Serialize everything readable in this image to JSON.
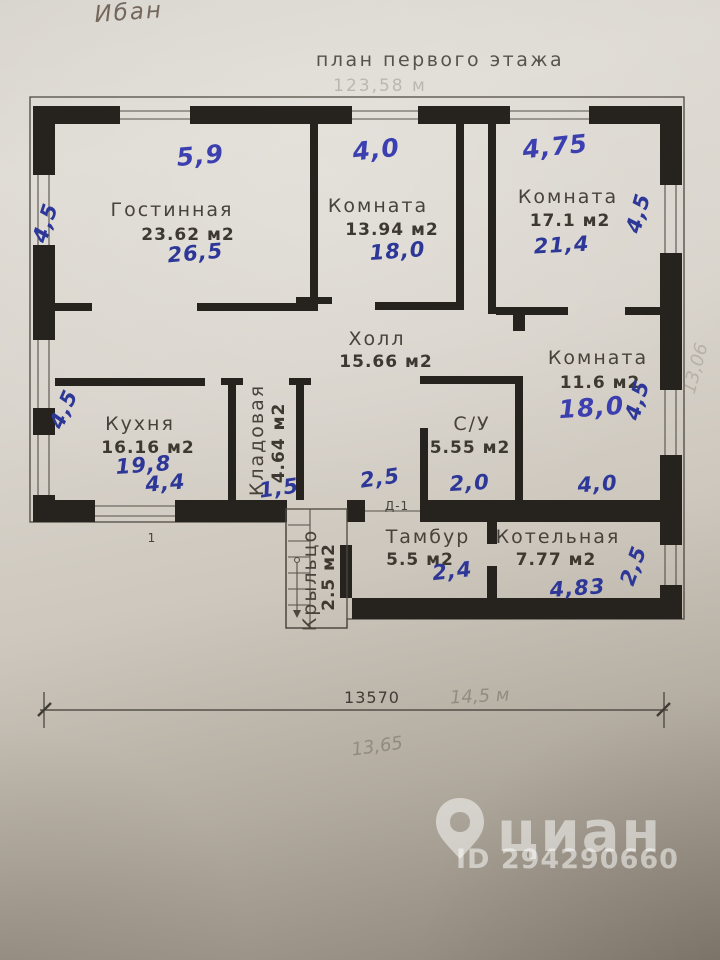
{
  "header": {
    "scribble": "Ибан",
    "title": "план первого этажа",
    "total_area_faint": "123,58 м"
  },
  "rooms": {
    "living": {
      "name": "Гостинная",
      "area": "23.62 м2",
      "hand": "26,5",
      "dim_top": "5,9",
      "dim_left": "4,5"
    },
    "bedroom_mid": {
      "name": "Комната",
      "area": "13.94 м2",
      "hand": "18,0",
      "dim_top": "4,0"
    },
    "bedroom_right": {
      "name": "Комната",
      "area": "17.1 м2",
      "hand": "21,4",
      "dim_top": "4,75",
      "dim_right": "4,5"
    },
    "hall": {
      "name": "Холл",
      "area": "15.66 м2"
    },
    "bedroom_small": {
      "name": "Комната",
      "area": "11.6 м2",
      "hand": "18,0",
      "dim_right": "4,5",
      "dim_bottom": "4,0"
    },
    "kitchen": {
      "name": "Кухня",
      "area": "16.16 м2",
      "hand": "19,8",
      "dim_left": "4,5",
      "dim_bottom": "4,4"
    },
    "pantry": {
      "name": "Кладовая",
      "area": "4.64 м2",
      "dim_bottom": "1,5"
    },
    "bathroom": {
      "name": "С/У",
      "area": "5.55 м2",
      "hand": "2,0",
      "dim_left": "2,5"
    },
    "tambour": {
      "name": "Тамбур",
      "area": "5.5 м2",
      "dim_bottom": "2,4"
    },
    "boiler": {
      "name": "Котельная",
      "area": "7.77 м2",
      "dim_bottom": "4,83",
      "dim_right": "2,5"
    },
    "porch": {
      "name": "Крыльцо",
      "area": "2.5 м2"
    }
  },
  "plan_labels": {
    "door": "Д-1",
    "wall_mark": "1"
  },
  "dimension": {
    "value": "13570",
    "pencil_note": "14,5 м",
    "pencil_note2": "13,65",
    "pencil_margin": "13,06"
  },
  "watermark": {
    "brand": "циан",
    "listing_id": "ID 294290660"
  },
  "colors": {
    "ink_blue": "#2c3798",
    "plan_black": "#26231e",
    "print_grey": "#47433a",
    "paper_light": "#dedad3",
    "paper_dark": "#8a8276"
  }
}
